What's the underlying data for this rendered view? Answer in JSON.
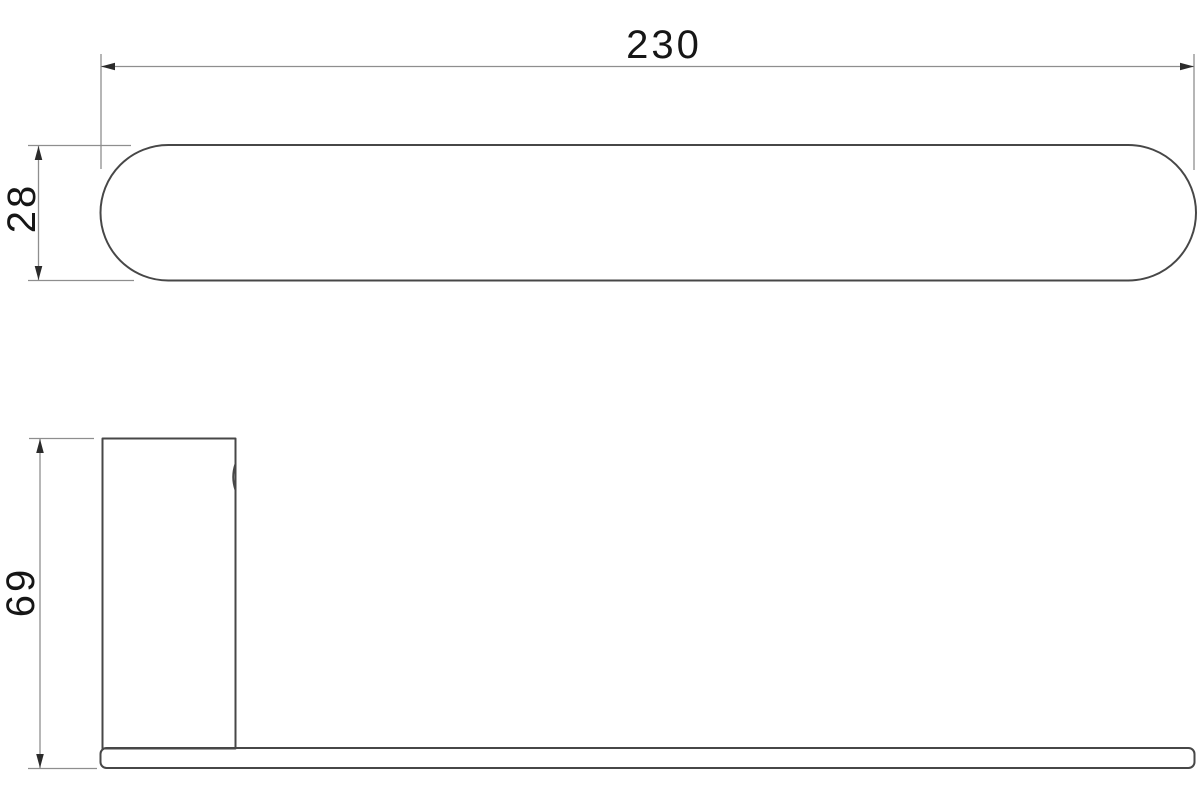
{
  "drawing": {
    "background_color": "#ffffff",
    "object_line_color": "#474747",
    "dimension_line_color": "#8e8e8e",
    "arrow_color": "#2b2b2b",
    "text_color": "#161616",
    "dimensions": {
      "length": "230",
      "bar_depth": "28",
      "height": "69"
    }
  }
}
